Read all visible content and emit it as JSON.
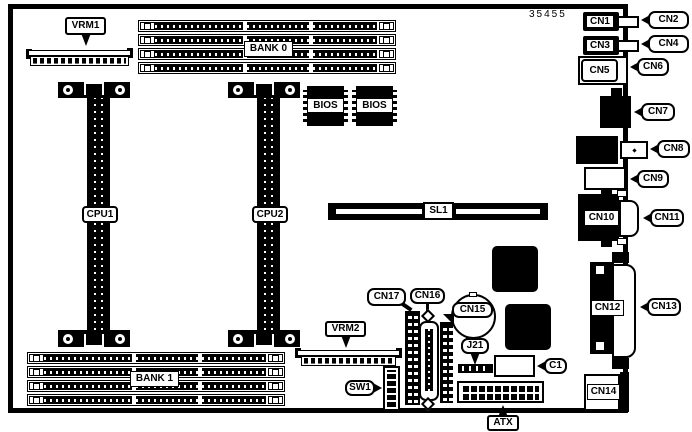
{
  "diagram": {
    "part_number": "35455",
    "labels": {
      "vrm1": "VRM1",
      "vrm2": "VRM2",
      "bank0": "BANK 0",
      "bank1": "BANK 1",
      "bios": "BIOS",
      "cpu1": "CPU1",
      "cpu2": "CPU2",
      "sl1": "SL1",
      "cn1": "CN1",
      "cn2": "CN2",
      "cn3": "CN3",
      "cn4": "CN4",
      "cn5": "CN5",
      "cn6": "CN6",
      "cn7": "CN7",
      "cn8": "CN8",
      "cn9": "CN9",
      "cn10": "CN10",
      "cn11": "CN11",
      "cn12": "CN12",
      "cn13": "CN13",
      "cn14": "CN14",
      "cn15": "CN15",
      "cn16": "CN16",
      "cn17": "CN17",
      "j21": "J21",
      "c1": "C1",
      "sw1": "SW1",
      "atx": "ATX"
    },
    "colors": {
      "ink": "#000000",
      "paper": "#ffffff"
    }
  }
}
